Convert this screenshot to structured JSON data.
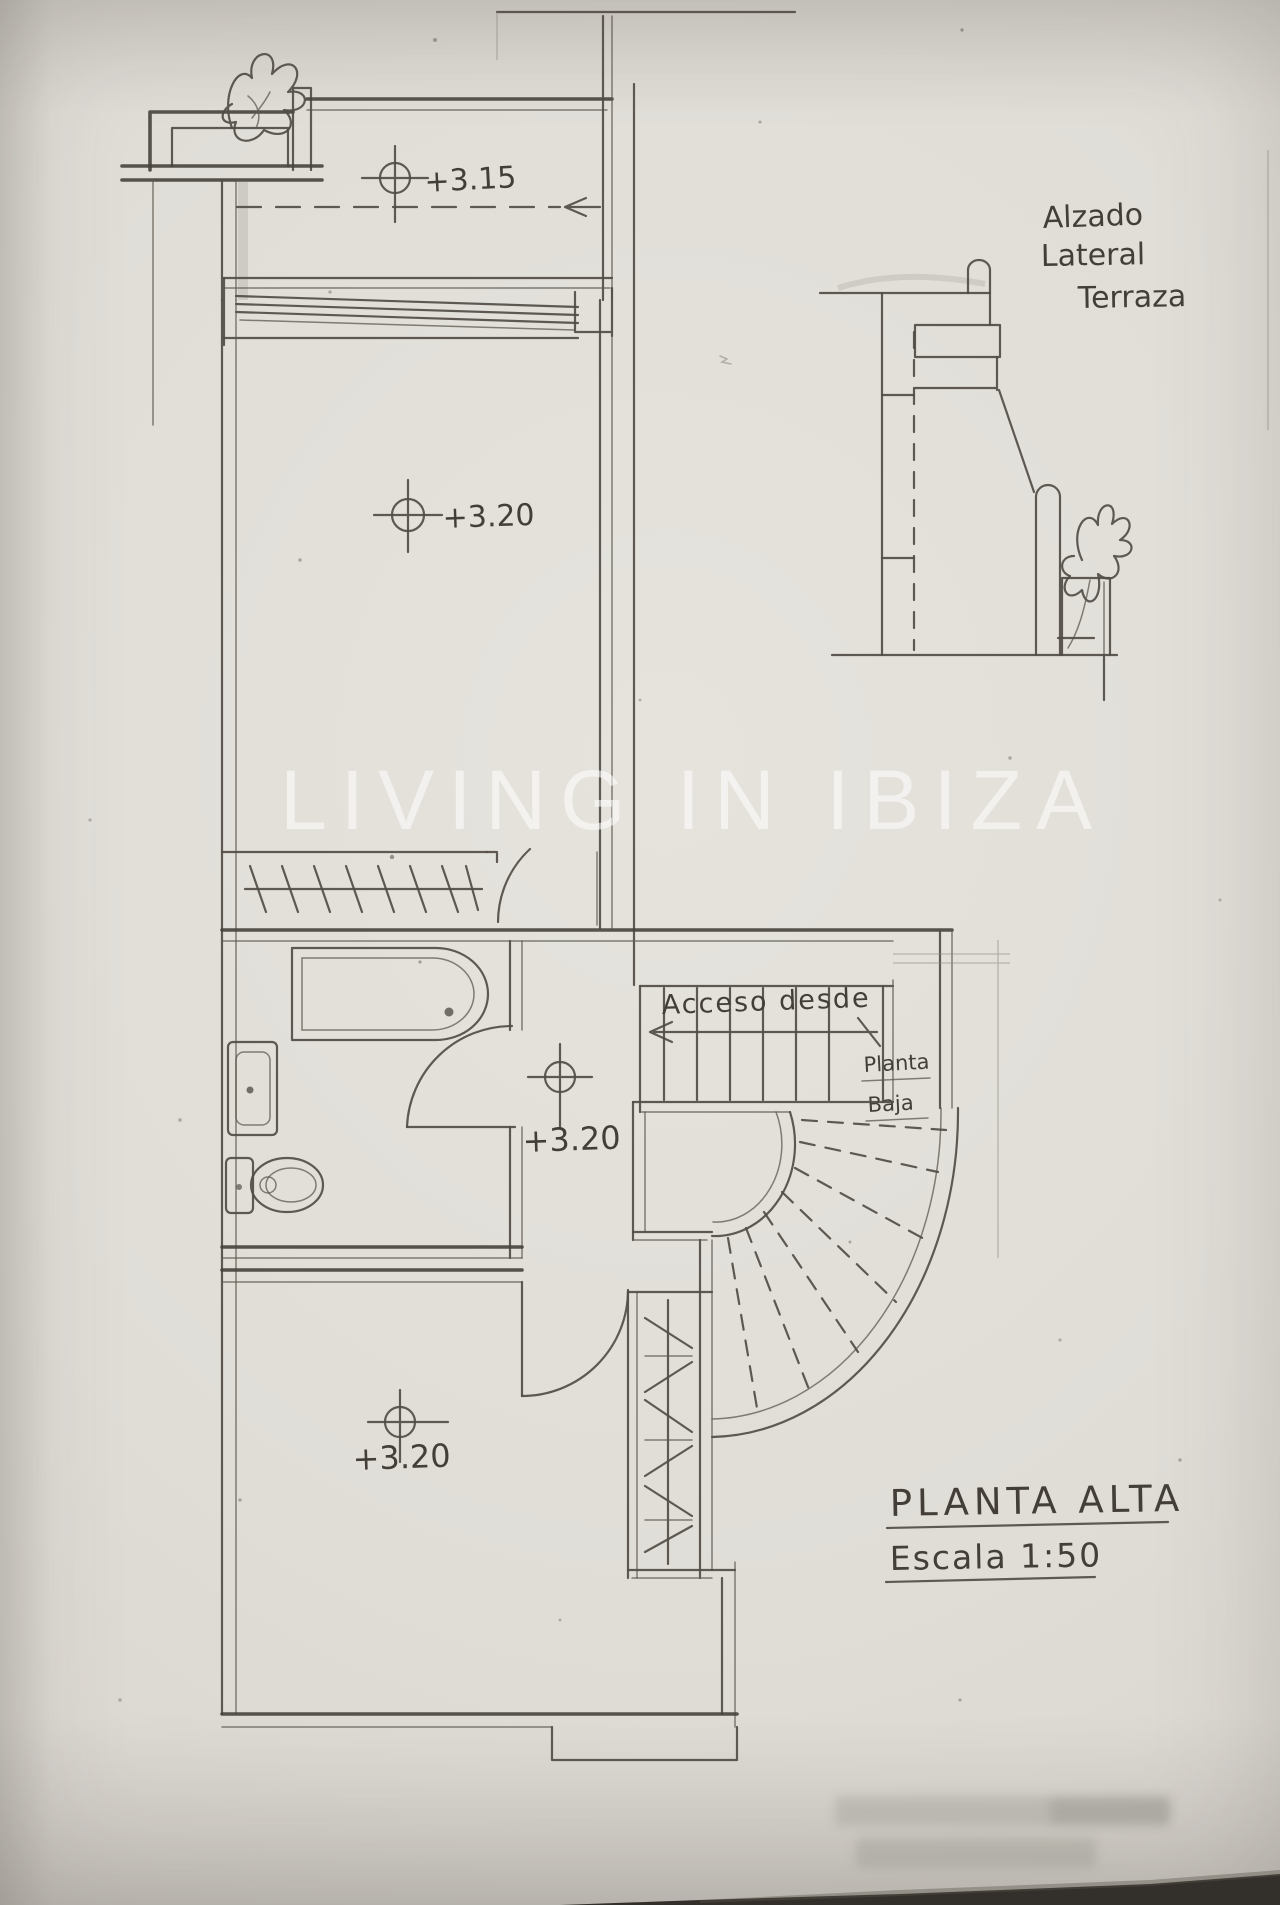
{
  "watermark": {
    "text": "LIVING IN IBIZA"
  },
  "plan": {
    "markers": {
      "terrace": "+3.15",
      "main_room": "+3.20",
      "hall": "+3.20",
      "lower_room": "+3.20"
    },
    "stairs": {
      "access_label": "Acceso desde",
      "target_line1": "Planta",
      "target_line2": "Baja"
    }
  },
  "elevation": {
    "label_line1": "Alzado",
    "label_line2": "Lateral",
    "label_line3": "Terraza"
  },
  "title_block": {
    "title": "PLANTA ALTA",
    "scale": "Escala 1:50"
  },
  "colors": {
    "paper": "#dedbd5",
    "pencil": "#4f4b44",
    "watermark_white": "#ffffff",
    "photo_edge_dark": "#332f2a"
  }
}
